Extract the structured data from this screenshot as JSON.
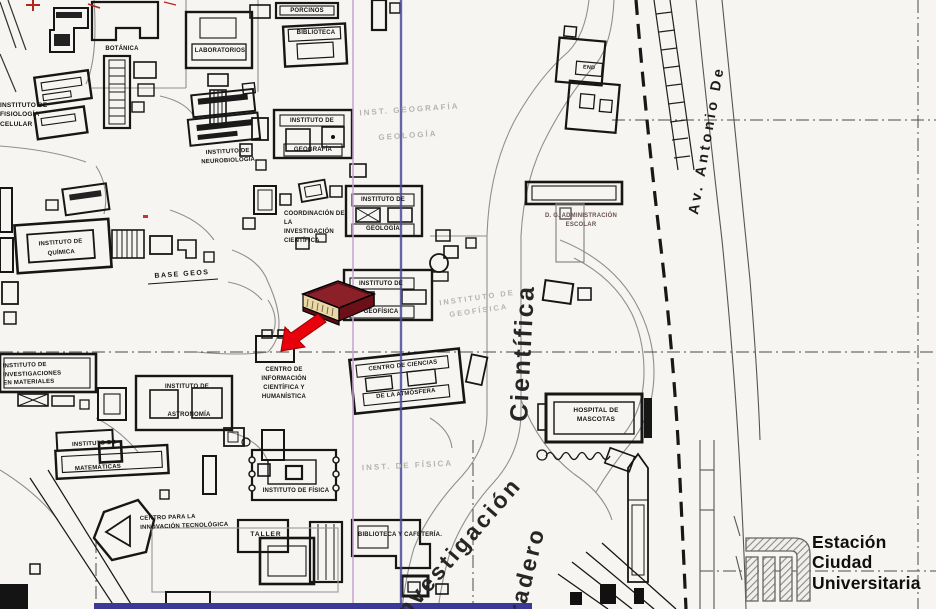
{
  "colors": {
    "paper": "#f7f5f1",
    "ink": "#161616",
    "outline_text": "#b4b4b4",
    "fold_pink": "#c9a3cf",
    "fold_blue": "#4f4a9e",
    "book_cover": "#8b2028",
    "book_dark": "#5e0f16",
    "book_pages": "#ead9a8",
    "arrow_red": "#e8000d",
    "bottom_strip": "#3a3a96"
  },
  "icons": {
    "marker": "book-icon",
    "marker_arrow": "red-arrow-icon",
    "station_logo": "metro-logo-icon"
  },
  "streets": {
    "av_antonio": "Av. Antonio De",
    "cientifica": "Científica",
    "investigacion": "Investigación",
    "paradero": "radero"
  },
  "station": {
    "text": "Estación\nCiudad\nUniversitaria"
  },
  "labels": {
    "fisiologia": "INSTITUTO DE\nFISIOLOGÍA\nCELULAR",
    "botanica": "BOTÁNICA",
    "laboratorios": "LABORATORIOS",
    "porcinos": "PORCINOS",
    "biblioteca": "BIBLIOTECA",
    "neurobiologia": "INSTITUTO DE\nNEUROBIOLOGÍA",
    "geografia_1": "INSTITUTO DE",
    "geografia_2": "GEOGRAFÍA",
    "inst_geografia_out": "INST. GEOGRAFÍA",
    "geologia_out": "GEOLOGÍA",
    "coordinacion": "COORDINACIÓN DE\nLA\nINVESTIGACIÓN\nCIENTÍFICA",
    "geologia_1": "INSTITUTO DE",
    "geologia_2": "GEOLOGÍA",
    "base_geos": "BASE GEOS",
    "quimica": "INSTITUTO DE\nQUÍMICA",
    "materiales": "INSTITUTO DE\nINVESTIGACIONES\nEN MATERIALES",
    "geofisica_1": "INSTITUTO DE",
    "geofisica_2": "GEOFÍSICA",
    "geofisica_out": "INSTITUTO DE\nGEOFÍSICA",
    "end_label": "END",
    "dg_admin": "D. G. ADMINISTRACIÓN\nESCOLAR",
    "cich": "CENTRO DE\nINFORMACIÓN\nCIENTÍFICA Y\nHUMANÍSTICA",
    "atmosfera_1": "CENTRO DE CIENCIAS",
    "atmosfera_2": "DE LA ATMÓSFERA",
    "astronomia_1": "INSTITUTO DE",
    "astronomia_2": "ASTRONOMÍA",
    "matematicas_1": "INSTITUTO DE",
    "matematicas_2": "MATEMÁTICAS",
    "fisica_out": "INST. DE FÍSICA",
    "fisica": "INSTITUTO DE FÍSICA",
    "innovacion": "CENTRO PARA LA\nINNOVACIÓN TECNOLÓGICA",
    "taller": "TALLER",
    "cafeteria": "BIBLIOTECA Y CAFETERÍA.",
    "mascotas": "HOSPITAL DE\nMASCOTAS"
  }
}
